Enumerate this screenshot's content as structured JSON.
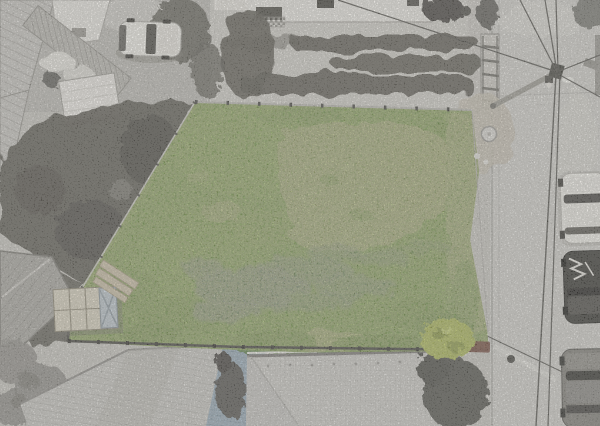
{
  "scene": {
    "type": "aerial-drone-photo",
    "subject": "Top-down drone photo of a vacant land plot shown in color (green grass, purple wildflowers, bare dirt) while the surrounding neighborhood — houses, sheds, garden beds, a road with parked cars and power lines — is desaturated grayscale",
    "palette": {
      "background": "#c6c4c0",
      "ground_mottle": "#bab8b4",
      "road": "#cfcecb",
      "road_light": "#dcdbd7",
      "curb": "#a9a8a5",
      "grass": "#6f9447",
      "grass_light": "#85a855",
      "grass_dark": "#4d772e",
      "grass_worn": "#8fa05e",
      "dirt": "#c9b99e",
      "dirt_light": "#d8cbb2",
      "flowers": "#8478b8",
      "shrub": "#46702c",
      "bush_yellow": "#a8b457",
      "blue_roof": "#94a8b8",
      "maroon_roof": "#6e453a",
      "white_roof": "#cbcac7",
      "corrugated_roof": "#c7c6c3",
      "tile_roof": "#c6c4c1",
      "shed_roof": "#a6a4a0",
      "white_shed": "#eceae7",
      "building_white": "#eae8e4",
      "garden_bed": "#53514c",
      "dark_vegetation": "#54524d",
      "tree_gray": "#8e8c89",
      "tree_dark": "#4e4d4a",
      "car_white": "#efeeea",
      "car_black": "#2f2e2c",
      "car_gray": "#7b7975",
      "crate": "#d6cfbf",
      "crate_panel": "#b8c2cb",
      "planks": "#c9bda6",
      "fence_dark": "#403f3c",
      "fence_light": "#b7b5b1",
      "wire": "#4e4d4a"
    },
    "objects": [
      {
        "name": "land-plot",
        "label": "colored vacant plot with grass, dirt scrapes and purple wildflowers"
      },
      {
        "name": "wildflower-patch",
        "label": "purple wildflower drift across lower middle of plot"
      },
      {
        "name": "dirt-patch",
        "label": "scraped bare-earth patch, upper middle of plot"
      },
      {
        "name": "storage-crate",
        "label": "small slatted crate inside plot near left fence"
      },
      {
        "name": "wood-planks",
        "label": "stack of boards by left fence"
      },
      {
        "name": "garden-beds",
        "label": "three dark tilled garden rows, top neighbor yard"
      },
      {
        "name": "house-top",
        "label": "white building at top edge"
      },
      {
        "name": "white-car",
        "label": "white car parked top-left"
      },
      {
        "name": "road",
        "label": "street along right edge"
      },
      {
        "name": "parked-car-white",
        "label": "white car parked on street"
      },
      {
        "name": "parked-car-black",
        "label": "black car with white markings parked on street"
      },
      {
        "name": "parked-car-gray",
        "label": "gray car parked on street"
      },
      {
        "name": "utility-pole",
        "label": "power pole with radiating wires, top right"
      },
      {
        "name": "hip-roof",
        "label": "large light hip roof, bottom center"
      },
      {
        "name": "blue-roof",
        "label": "blue-gray corrugated roof section, bottom"
      },
      {
        "name": "metal-shed-roof",
        "label": "gray ribbed shed roof, lower left"
      },
      {
        "name": "gray-tree",
        "label": "desaturated tree canopy, bottom-left corner"
      },
      {
        "name": "dark-tree",
        "label": "dark tree canopy, bottom-right of plot"
      },
      {
        "name": "yellow-bush",
        "label": "yellow-green bush at plot's bottom-right corner"
      },
      {
        "name": "well-cover",
        "label": "round utility cover near plot's top-right corner"
      }
    ]
  }
}
